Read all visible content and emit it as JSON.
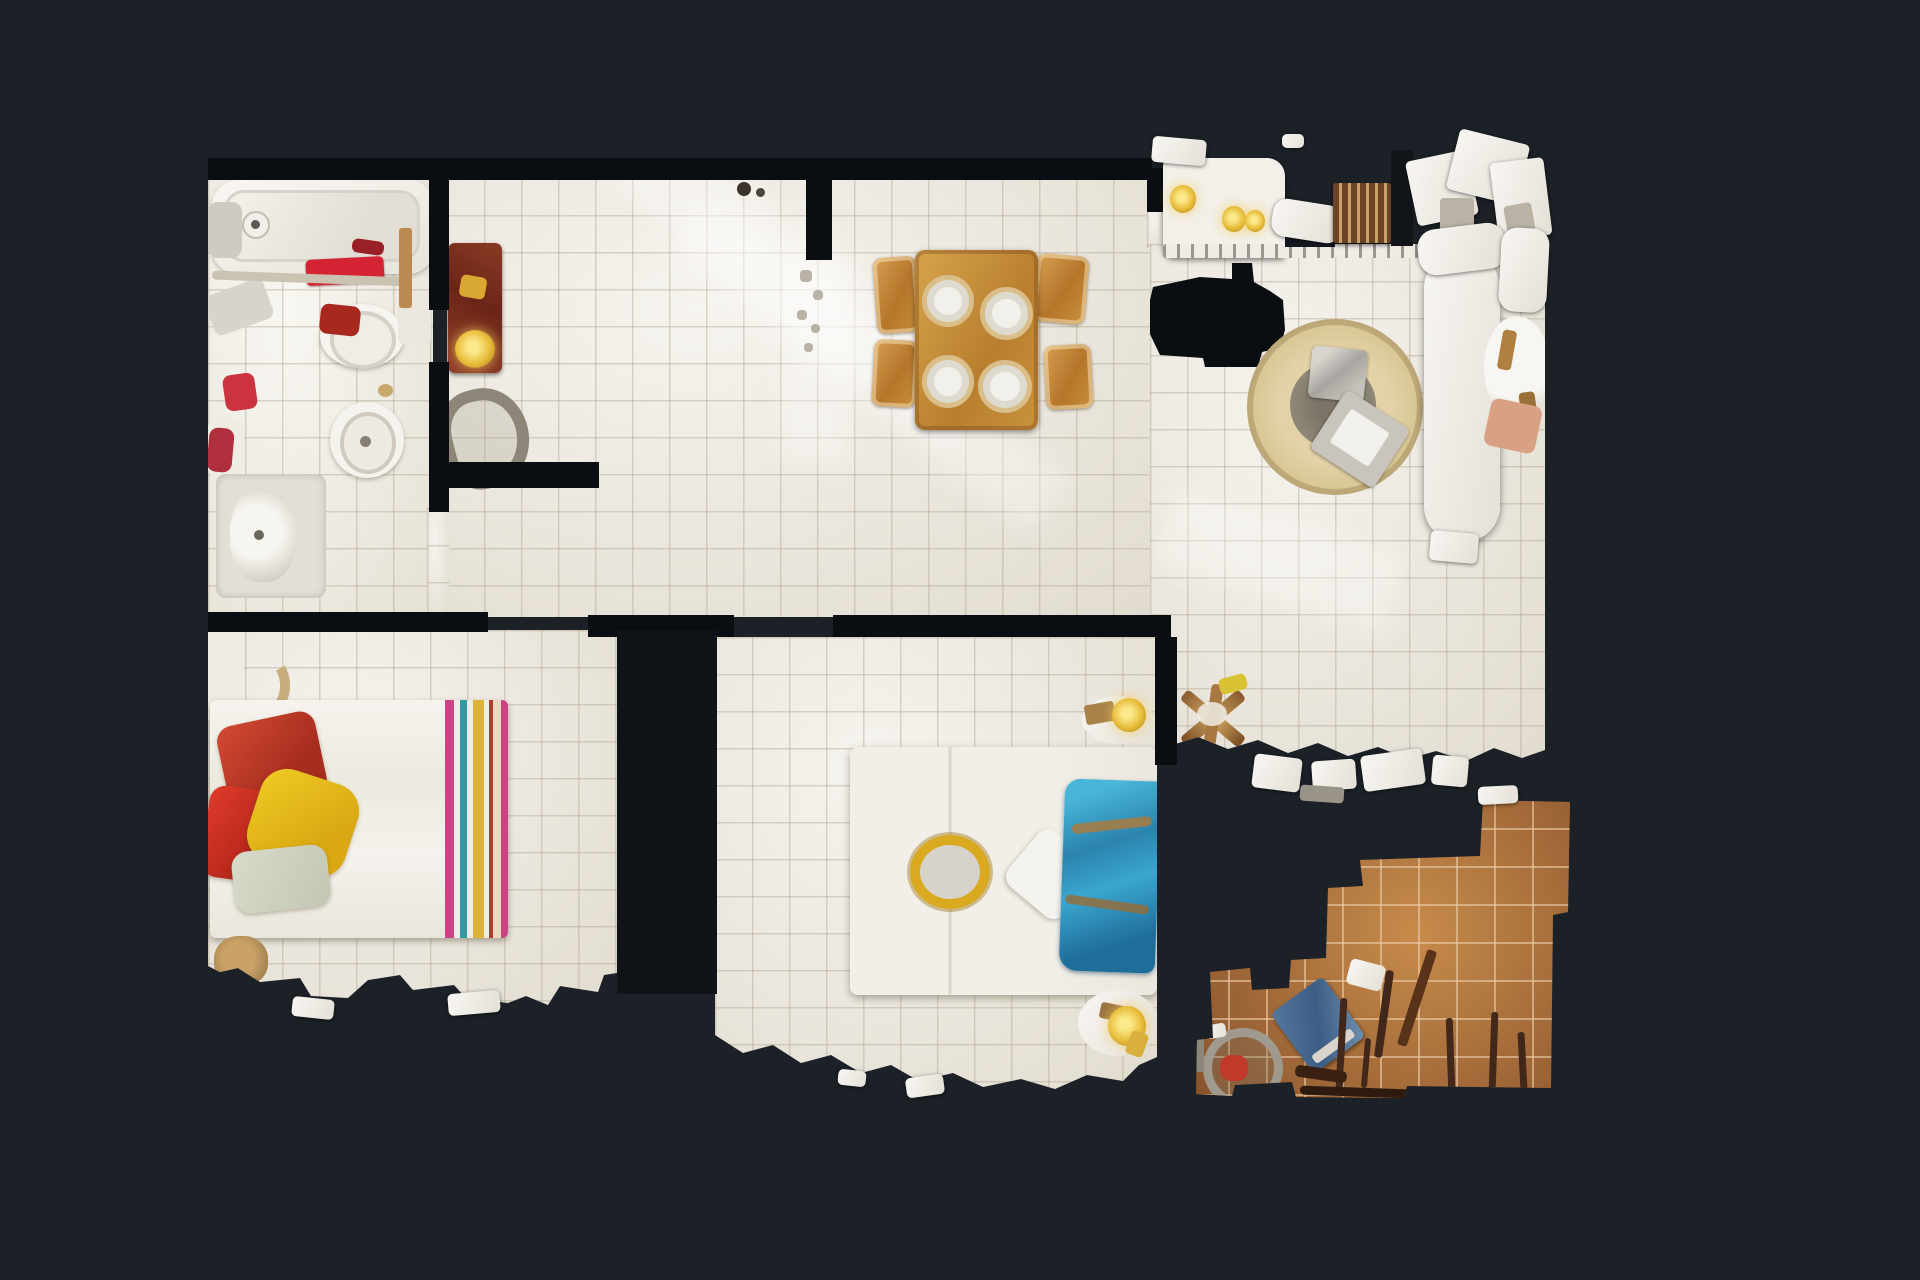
{
  "view": {
    "type": "3d-scan-floorplan-top-down",
    "description": "Top-down dollhouse view of an apartment photogrammetry scan on a dark background"
  },
  "colors": {
    "background": "#1b2127",
    "wall": "#0a0d11",
    "floor": "#ebe6db",
    "floor_bright": "#f0ece2",
    "terracotta": "#a2653a",
    "rug": "#d9c795",
    "wood": "#c08c3a",
    "white_obj": "#f4f1ea",
    "towel_red": "#d42332",
    "pillow_red": "#c23b2a",
    "pillow_yellow": "#e7c11c",
    "blanket_blue": "#3ba3cc",
    "stripe_pink": "#cb4384",
    "stripe_teal": "#2f9aa0",
    "stripe_yellow": "#ddb33c",
    "gold": "#dcae2e",
    "salmon": "#d9a184",
    "maroon": "#7c2e1c",
    "tan": "#c8ae7c",
    "gray_object": "#8d8577",
    "scan_void": "#0c0f13"
  },
  "rooms": [
    {
      "id": "bathroom",
      "label": "Bathroom",
      "items": [
        "bathtub",
        "toilet",
        "bidet",
        "sink-vanity",
        "red-towels",
        "open-door"
      ]
    },
    {
      "id": "hall-dining",
      "label": "Hall / Dining",
      "items": [
        "dining-table",
        "four-plates",
        "four-chairs",
        "armchair",
        "floor-lamp",
        "bag"
      ]
    },
    {
      "id": "kitchen",
      "label": "Kitchen",
      "items": [
        "counter",
        "pendant-lights"
      ]
    },
    {
      "id": "living",
      "label": "Living room",
      "items": [
        "round-jute-rug",
        "ottoman",
        "serving-trays",
        "sofa",
        "round-side-table",
        "x-folding-table",
        "scan-hole"
      ]
    },
    {
      "id": "bedroom-left",
      "label": "Bedroom 1",
      "items": [
        "double-bed",
        "striped-blanket",
        "red-pillows",
        "yellow-pillow",
        "sage-pillow",
        "door-arc",
        "bag"
      ]
    },
    {
      "id": "bedroom-middle",
      "label": "Bedroom 2",
      "items": [
        "double-bed",
        "blue-blanket",
        "white-pillow",
        "gold-ring-pillow",
        "nightstand-lamps"
      ]
    },
    {
      "id": "terrace",
      "label": "Terrace",
      "items": [
        "terracotta-tiles",
        "railing-bars",
        "hose-reel",
        "blue-board"
      ]
    }
  ]
}
